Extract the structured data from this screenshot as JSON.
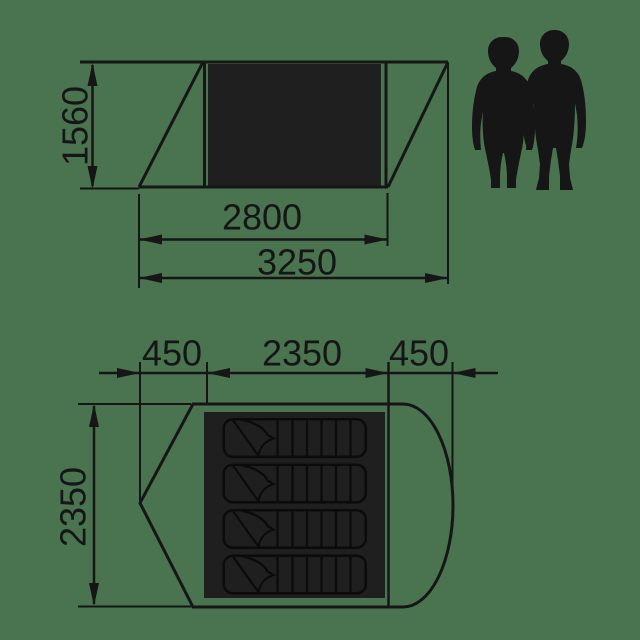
{
  "diagram": {
    "type": "tent-dimension-drawing",
    "side_view": {
      "height": "1560",
      "inner_width": "2800",
      "outer_width": "3250"
    },
    "top_view": {
      "left_section": "450",
      "middle_section": "2350",
      "right_section": "450",
      "depth": "2350",
      "sleeping_bag_count": 4
    },
    "scale_figures": [
      "woman-silhouette",
      "man-silhouette"
    ]
  },
  "colors": {
    "background": "#4A7350",
    "ink": "#161616",
    "panel": "#1F1F1F",
    "bag_line": "#0B0B0B"
  }
}
